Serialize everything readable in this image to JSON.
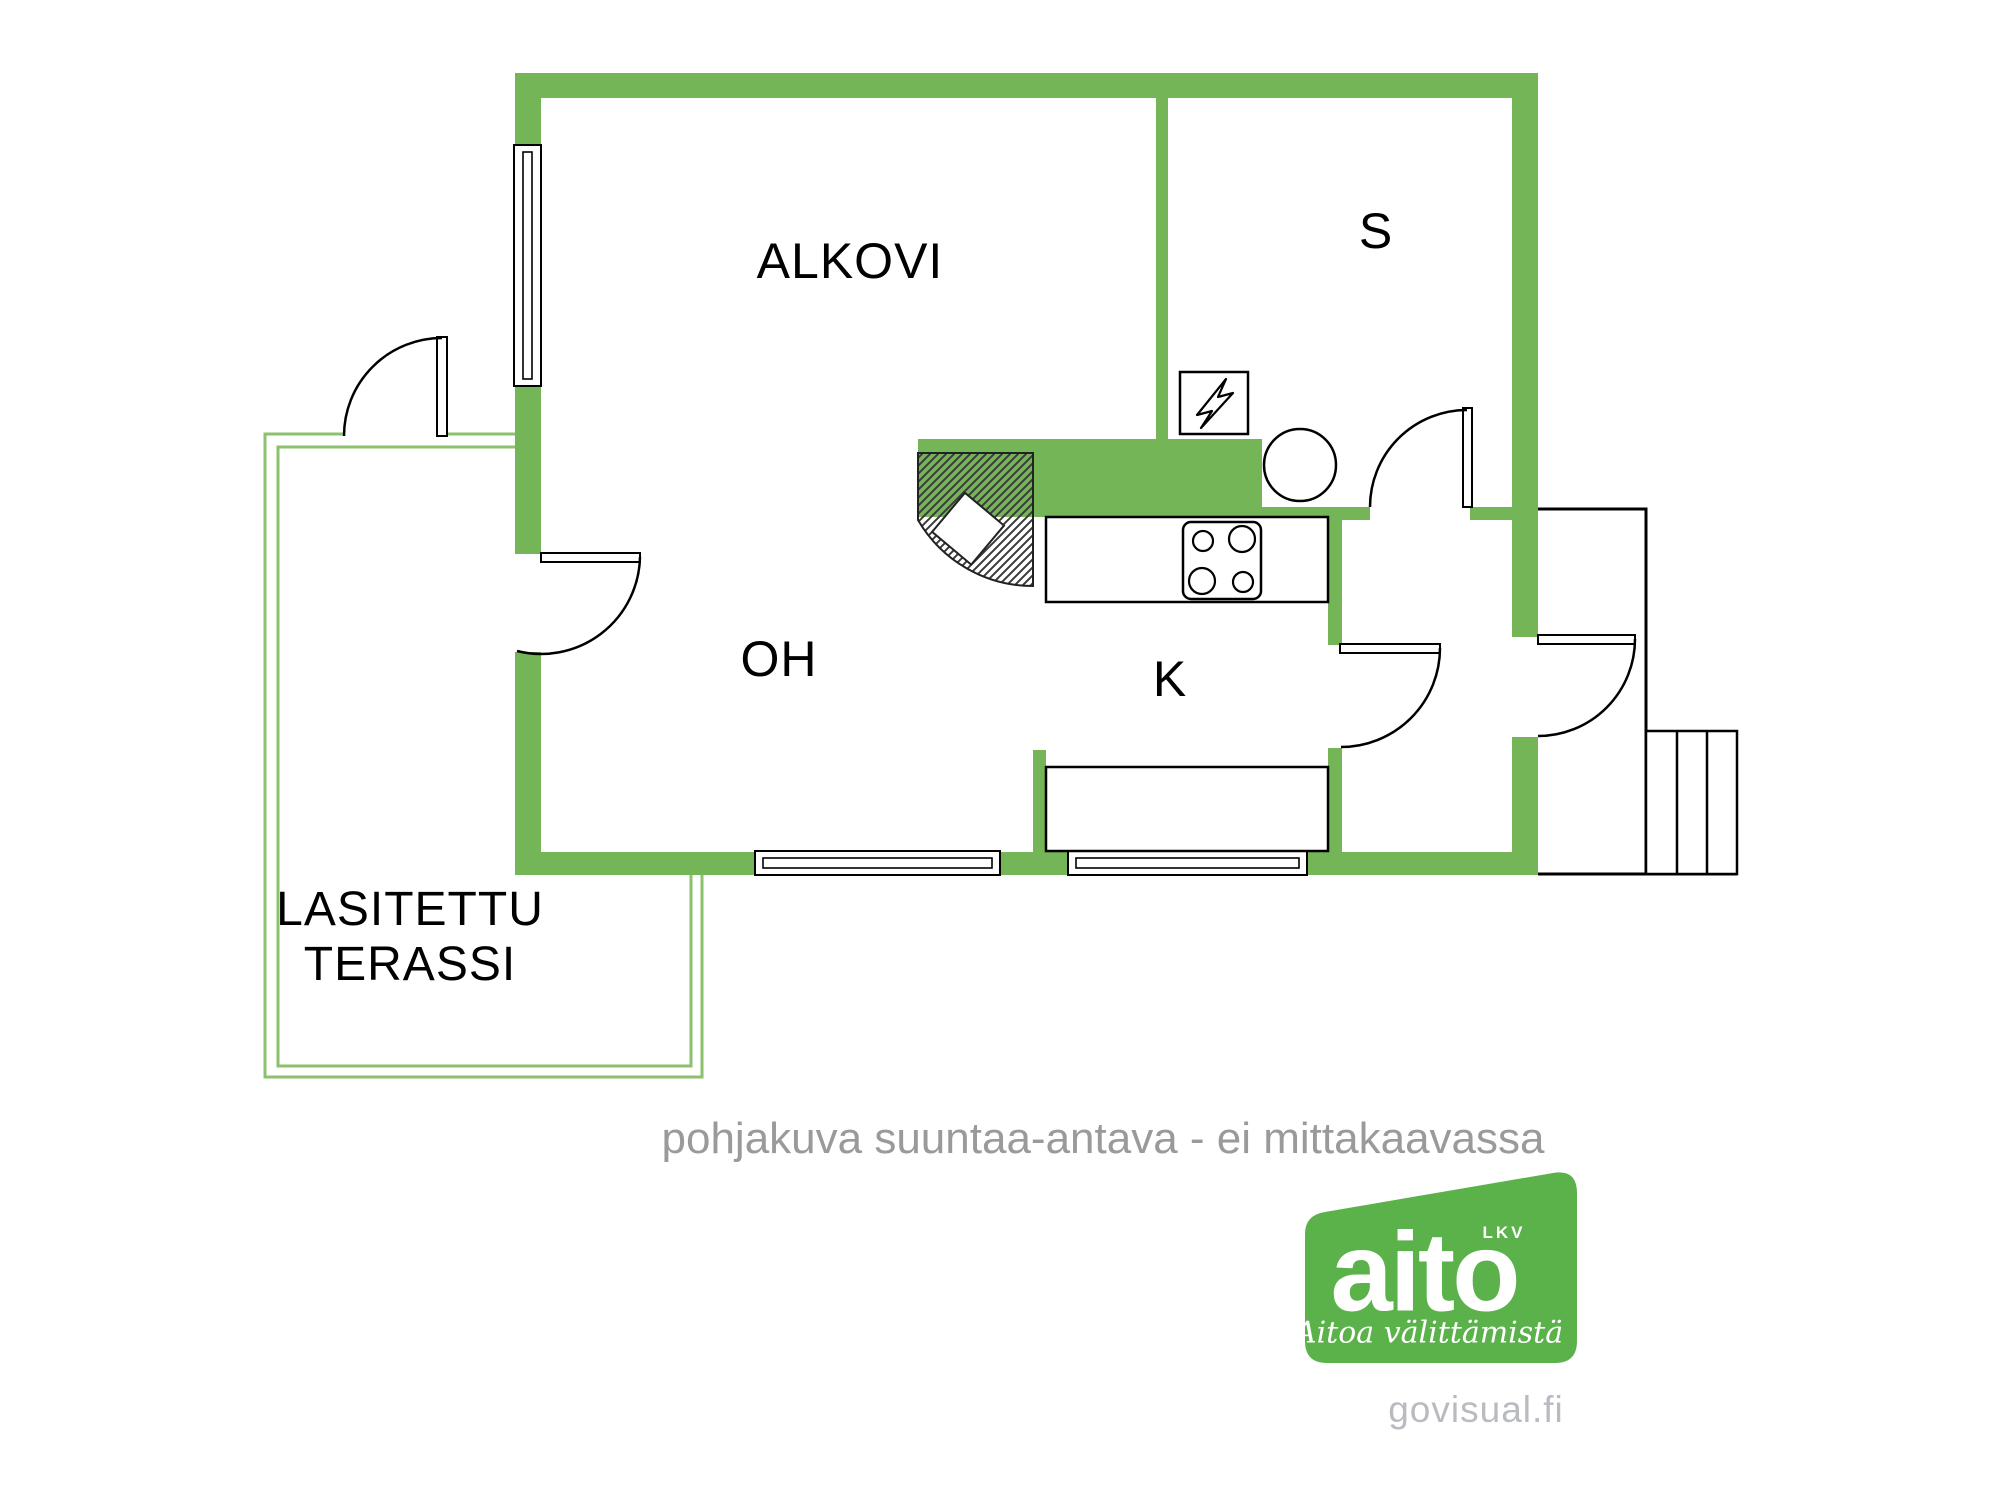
{
  "rooms": {
    "alkovi": {
      "label": "ALKOVI"
    },
    "sauna": {
      "label": "S"
    },
    "living_room": {
      "label": "OH"
    },
    "kitchen": {
      "label": "K"
    },
    "terrace": {
      "label_line1": "LASITETTU",
      "label_line2": "TERASSI"
    }
  },
  "caption": "pohjakuva suuntaa-antava - ei mittakaavassa",
  "logo": {
    "brand": "aito",
    "badge": "LKV",
    "tagline": "Aitoa välittämistä",
    "website": "govisual.fi"
  },
  "colors": {
    "wall_green": "#74b657",
    "terrace_outline_green": "#8cc16d",
    "logo_green": "#5bb24b",
    "caption_gray": "#9a9a9a",
    "website_gray": "#b9bbc0",
    "line_black": "#000000"
  },
  "icons": {
    "electric_heater": "lightning-bolt-square",
    "water_heater": "circle",
    "stove": "four-burner-cooktop",
    "fireplace": "hatched-corner-hearth",
    "stairs": "three-step-run",
    "windows": "double-line-window",
    "doors": "quarter-arc-swing-door"
  }
}
